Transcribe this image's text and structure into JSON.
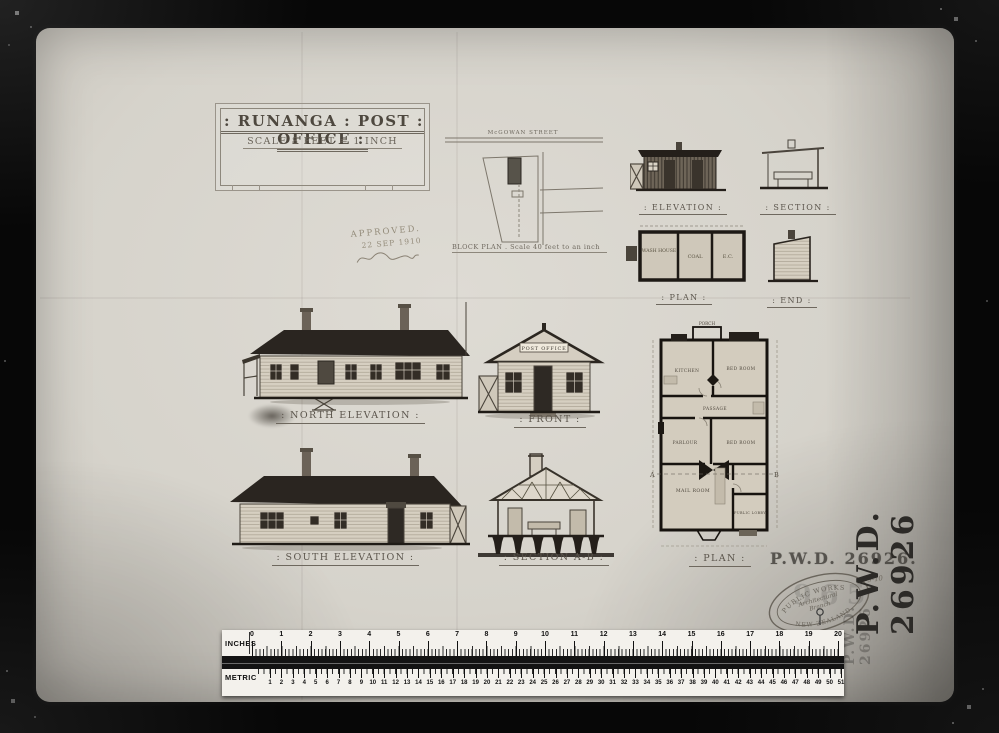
{
  "colors": {
    "background": "#070707",
    "paper": "#d6d3cb",
    "ink": "#56504a",
    "dark_wash": "#2a2520",
    "stamp_ink": "#45423d"
  },
  "title_block": {
    "title": ": RUNANGA : POST : OFFICE :",
    "scale_note": "SCALE  8 FEET = 1 INCH"
  },
  "approval": {
    "line1": "APPROVED.",
    "date": "22 SEP 1910"
  },
  "block_plan": {
    "street": "McGOWAN  STREET",
    "caption": "BLOCK PLAN .    Scale 40 feet to an inch"
  },
  "outbuilding": {
    "elevation_label": ": ELEVATION :",
    "section_label": ": SECTION :",
    "plan_label": ": PLAN :",
    "end_label": ": END :",
    "rooms": {
      "washhouse": "WASH HOUSE",
      "coal": "COAL",
      "ec": "E.C."
    }
  },
  "drawings": {
    "north_elevation_label": ": NORTH ELEVATION :",
    "front_label": ": FRONT :",
    "south_elevation_label": ": SOUTH ELEVATION :",
    "section_ab_label": ": SECTION A-B :",
    "plan_label": ": PLAN :",
    "post_office_sign": "POST OFFICE"
  },
  "floor_plan": {
    "porch": "PORCH",
    "kitchen": "KITCHEN",
    "bedroom_ne": "BED ROOM",
    "passage": "PASSAGE",
    "parlour": "PARLOUR",
    "bedroom_mid": "BED ROOM",
    "mail_room": "MAIL ROOM",
    "public_lobby": "PUBLIC LOBBY",
    "marker_a": "A",
    "marker_b": "B"
  },
  "stamps": {
    "pwd_number": "P.W.D. 26926.",
    "pwd_vertical": "P.W.D. 26926",
    "date_note": "10-9-10",
    "oval_top": "PUBLIC WORKS",
    "oval_middle1": "Architectural",
    "oval_middle2": "Branch",
    "oval_bottom": "NEW ZEALAND",
    "ghost_digits": "965"
  },
  "ruler": {
    "inches_label": "INCHES",
    "metric_label": "METRIC",
    "inch_start": 0,
    "inch_end": 20,
    "cm_start": 1,
    "cm_end": 51
  }
}
